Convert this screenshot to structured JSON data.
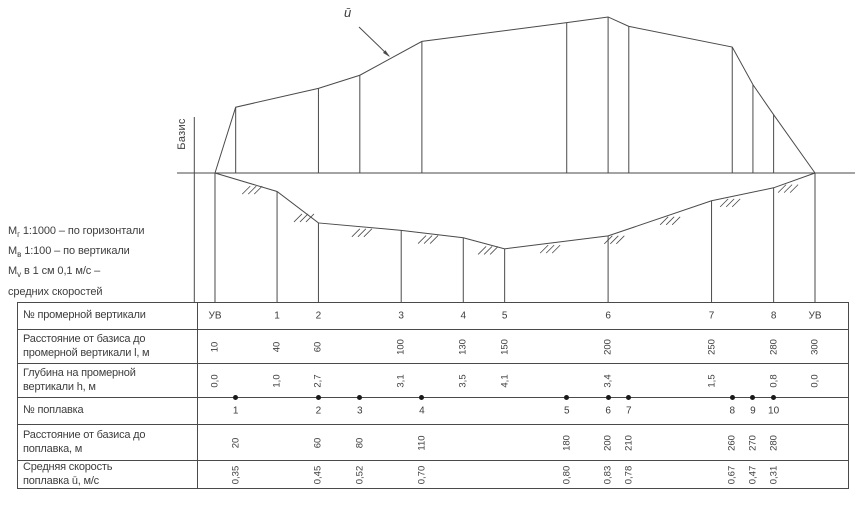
{
  "header": {
    "velocity_label": "ū",
    "basis_label": "Базис"
  },
  "scale_note": {
    "line1": {
      "m": "М",
      "sub": "г",
      "rest": " 1:1000 – по горизонтали"
    },
    "line2": {
      "m": "М",
      "sub": "в",
      "rest": " 1:100 – по вертикали"
    },
    "line3": {
      "m": "М",
      "sub": "v",
      "rest": " в 1 см 0,1 м/с –"
    },
    "line4": "средних скоростей"
  },
  "table": {
    "row_labels": [
      [
        "№ промерной вертикали"
      ],
      [
        "Расстояние от базиса до",
        "промерной вертикали l, м"
      ],
      [
        "Глубина на промерной",
        "вертикали h, м"
      ],
      [
        "№ поплавка"
      ],
      [
        "Расстояние от базиса до",
        "поплавка, м"
      ],
      [
        "Средняя скорость",
        "поплавка ū, м/с"
      ]
    ]
  },
  "verticals": [
    {
      "id": "УВ",
      "distance_m": 10,
      "depth_m": "0,0"
    },
    {
      "id": "1",
      "distance_m": 40,
      "depth_m": "1,0"
    },
    {
      "id": "2",
      "distance_m": 60,
      "depth_m": "2,7"
    },
    {
      "id": "3",
      "distance_m": 100,
      "depth_m": "3,1"
    },
    {
      "id": "4",
      "distance_m": 130,
      "depth_m": "3,5"
    },
    {
      "id": "5",
      "distance_m": 150,
      "depth_m": "4,1"
    },
    {
      "id": "6",
      "distance_m": 200,
      "depth_m": "3,4"
    },
    {
      "id": "7",
      "distance_m": 250,
      "depth_m": "1,5"
    },
    {
      "id": "8",
      "distance_m": 280,
      "depth_m": "0,8"
    },
    {
      "id": "УВ",
      "distance_m": 300,
      "depth_m": "0,0"
    }
  ],
  "floats": [
    {
      "id": "1",
      "distance_m": 20,
      "velocity_ms": "0,35"
    },
    {
      "id": "2",
      "distance_m": 60,
      "velocity_ms": "0,45"
    },
    {
      "id": "3",
      "distance_m": 80,
      "velocity_ms": "0,52"
    },
    {
      "id": "4",
      "distance_m": 110,
      "velocity_ms": "0,70"
    },
    {
      "id": "5",
      "distance_m": 180,
      "velocity_ms": "0,80"
    },
    {
      "id": "6",
      "distance_m": 200,
      "velocity_ms": "0,83"
    },
    {
      "id": "7",
      "distance_m": 210,
      "velocity_ms": "0,78"
    },
    {
      "id": "8",
      "distance_m": 260,
      "velocity_ms": "0,67"
    },
    {
      "id": "9",
      "distance_m": 270,
      "velocity_ms": "0,47"
    },
    {
      "id": "10",
      "distance_m": 280,
      "velocity_ms": "0,31"
    }
  ],
  "diagram": {
    "hatch_distances_m": [
      28,
      53,
      81,
      113,
      142,
      172,
      203,
      230,
      259,
      287
    ],
    "line_color": "#4a4a4a"
  }
}
